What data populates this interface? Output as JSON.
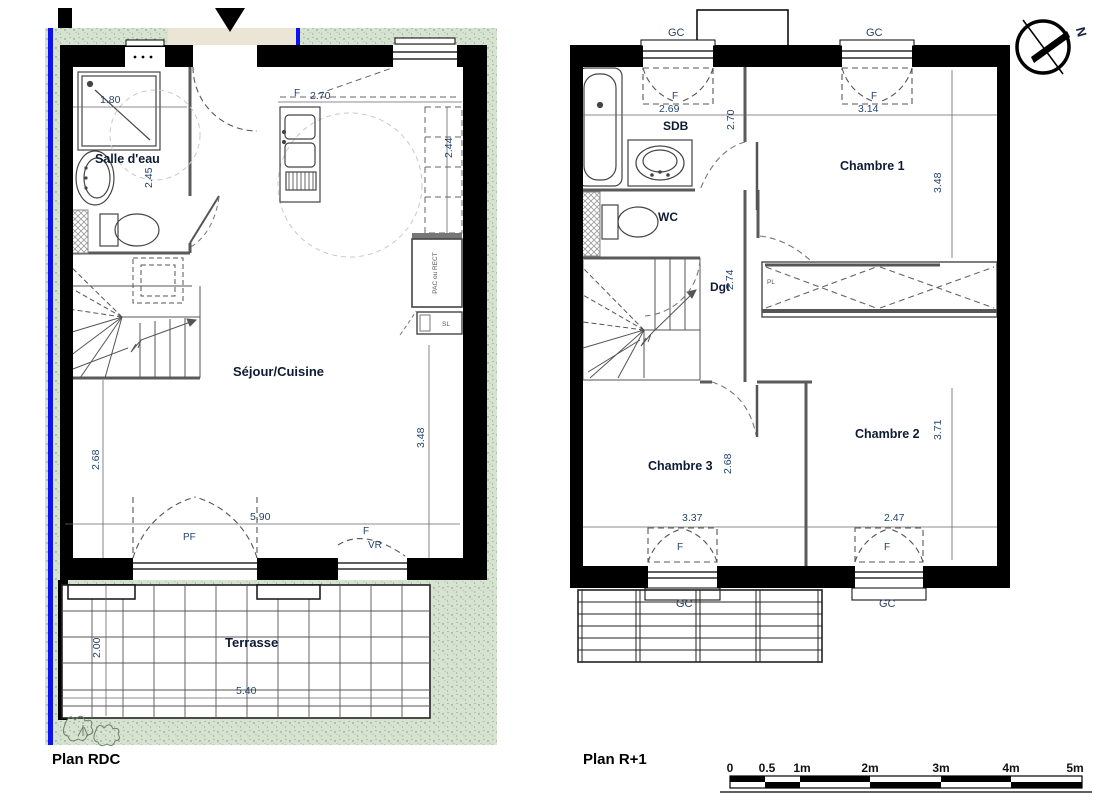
{
  "titles": {
    "rdc": "Plan RDC",
    "r1": "Plan R+1"
  },
  "compass": {
    "north": "N"
  },
  "scale_bar": {
    "ticks": [
      "0",
      "0.5",
      "1m",
      "2m",
      "3m",
      "4m",
      "5m"
    ]
  },
  "rdc": {
    "rooms": {
      "salle_deau": "Salle d'eau",
      "sejour_cuisine": "Séjour/Cuisine",
      "terrasse": "Terrasse"
    },
    "dims": {
      "shower_width": "1.80",
      "salle_depth": "2.45",
      "kitchen_width": "2.70",
      "kitchen_depth": "2.44",
      "left_height": "2.68",
      "right_height": "3.48",
      "bay_width": "5.90",
      "terrasse_depth": "2.00",
      "terrasse_width": "5.40"
    },
    "openings": {
      "window": "F",
      "bay": "PF",
      "shutter": "VR"
    },
    "equipment": {
      "heat_pump": "PAC ou RECT",
      "washer": "SL"
    }
  },
  "r1": {
    "rooms": {
      "sdb": "SDB",
      "wc": "WC",
      "degagement": "Dgt",
      "chambre1": "Chambre 1",
      "chambre2": "Chambre 2",
      "chambre3": "Chambre 3"
    },
    "dims": {
      "sdb_window_width": "2.69",
      "ch1_window_width": "3.14",
      "sdb_depth": "2.70",
      "dgt_depth": "2.74",
      "ch1_height": "3.48",
      "ch2_height": "3.71",
      "ch2_width": "2.47",
      "ch3_height": "2.68",
      "ch3_width": "3.37"
    },
    "openings": {
      "window": "F",
      "closet": "PL",
      "guardrail": "GC"
    }
  }
}
